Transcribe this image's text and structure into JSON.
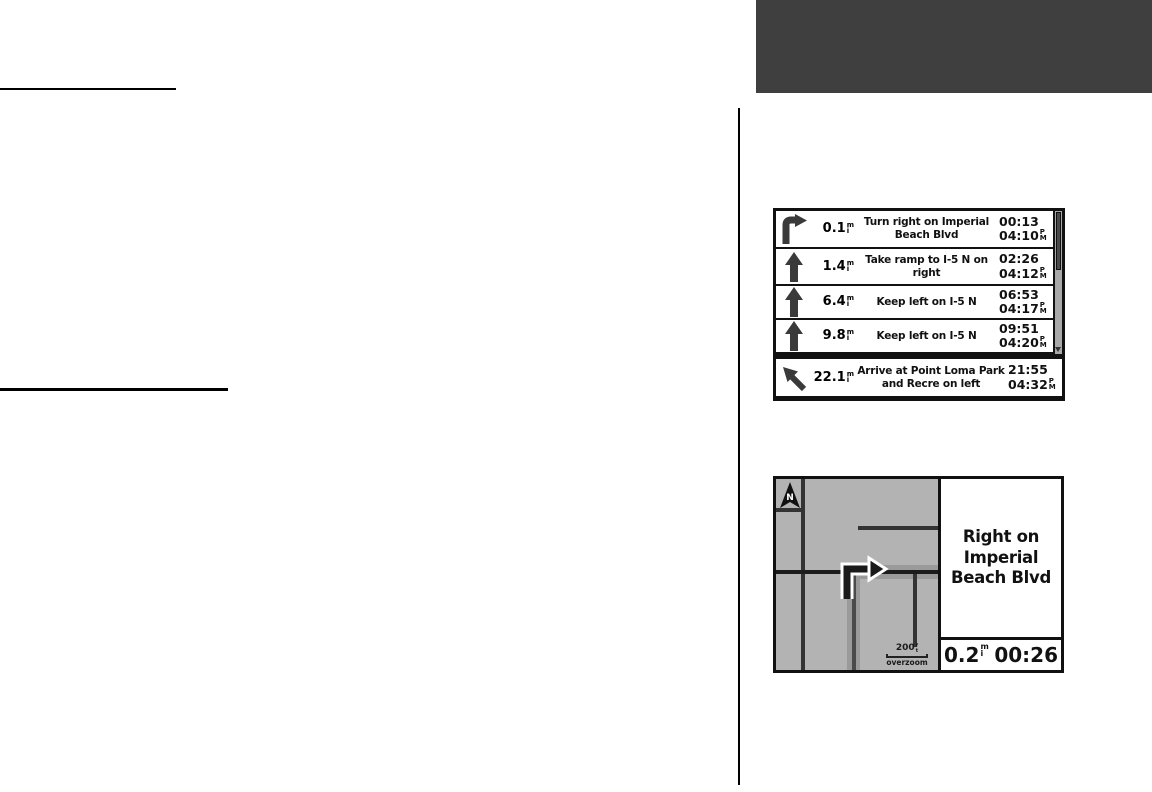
{
  "page": {
    "header_block_color": "#3f3f3f",
    "rule_color": "#000000"
  },
  "turn_list": {
    "units": {
      "dist_top": "m",
      "dist_bottom": "i",
      "ampm_top": "P",
      "ampm_bottom": "M"
    },
    "rows": [
      {
        "icon": "turn-right-icon",
        "distance": "0.1",
        "text": "Turn right on Imperial Beach Blvd",
        "eta": "00:13",
        "clock": "04:10"
      },
      {
        "icon": "straight-icon",
        "distance": "1.4",
        "text": "Take ramp to I-5 N on right",
        "eta": "02:26",
        "clock": "04:12"
      },
      {
        "icon": "straight-icon",
        "distance": "6.4",
        "text": "Keep left on I-5 N",
        "eta": "06:53",
        "clock": "04:17"
      },
      {
        "icon": "straight-icon",
        "distance": "9.8",
        "text": "Keep left on I-5 N",
        "eta": "09:51",
        "clock": "04:20"
      },
      {
        "icon": "arrive-left-icon",
        "distance": "22.1",
        "text": "Arrive at Point Loma Park and Recre on left",
        "eta": "21:55",
        "clock": "04:32"
      }
    ]
  },
  "map": {
    "north_label": "N",
    "scale_value": "200",
    "scale_unit_top": "f",
    "scale_unit_bottom": "t",
    "overzoom_label": "overzoom",
    "instruction": "Right on Imperial Beach Blvd",
    "distance": "0.2",
    "time": "00:26",
    "colors": {
      "map_bg": "#b3b3b3",
      "road": "#333333",
      "route_highlight": "#9a9a9a"
    }
  }
}
